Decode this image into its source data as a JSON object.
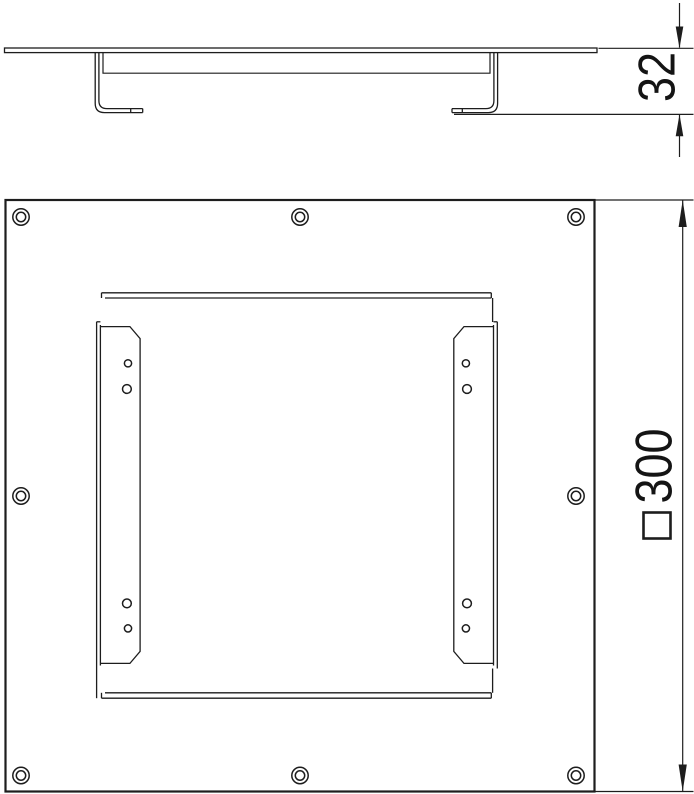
{
  "drawing": {
    "kind": "technical dimension drawing",
    "colors": {
      "line": "#1d1d1d",
      "background": "#ffffff",
      "dimension_text": "#141414"
    },
    "views": {
      "side_view": {
        "dimension_height": {
          "value": "32",
          "orientation": "rotated-90"
        }
      },
      "plan_view": {
        "dimension_width": {
          "value": "300",
          "symbol": "□",
          "orientation": "rotated-90"
        },
        "screw_hole_count": "8",
        "rail_count": "2",
        "rail_hole_count": "8"
      }
    }
  }
}
